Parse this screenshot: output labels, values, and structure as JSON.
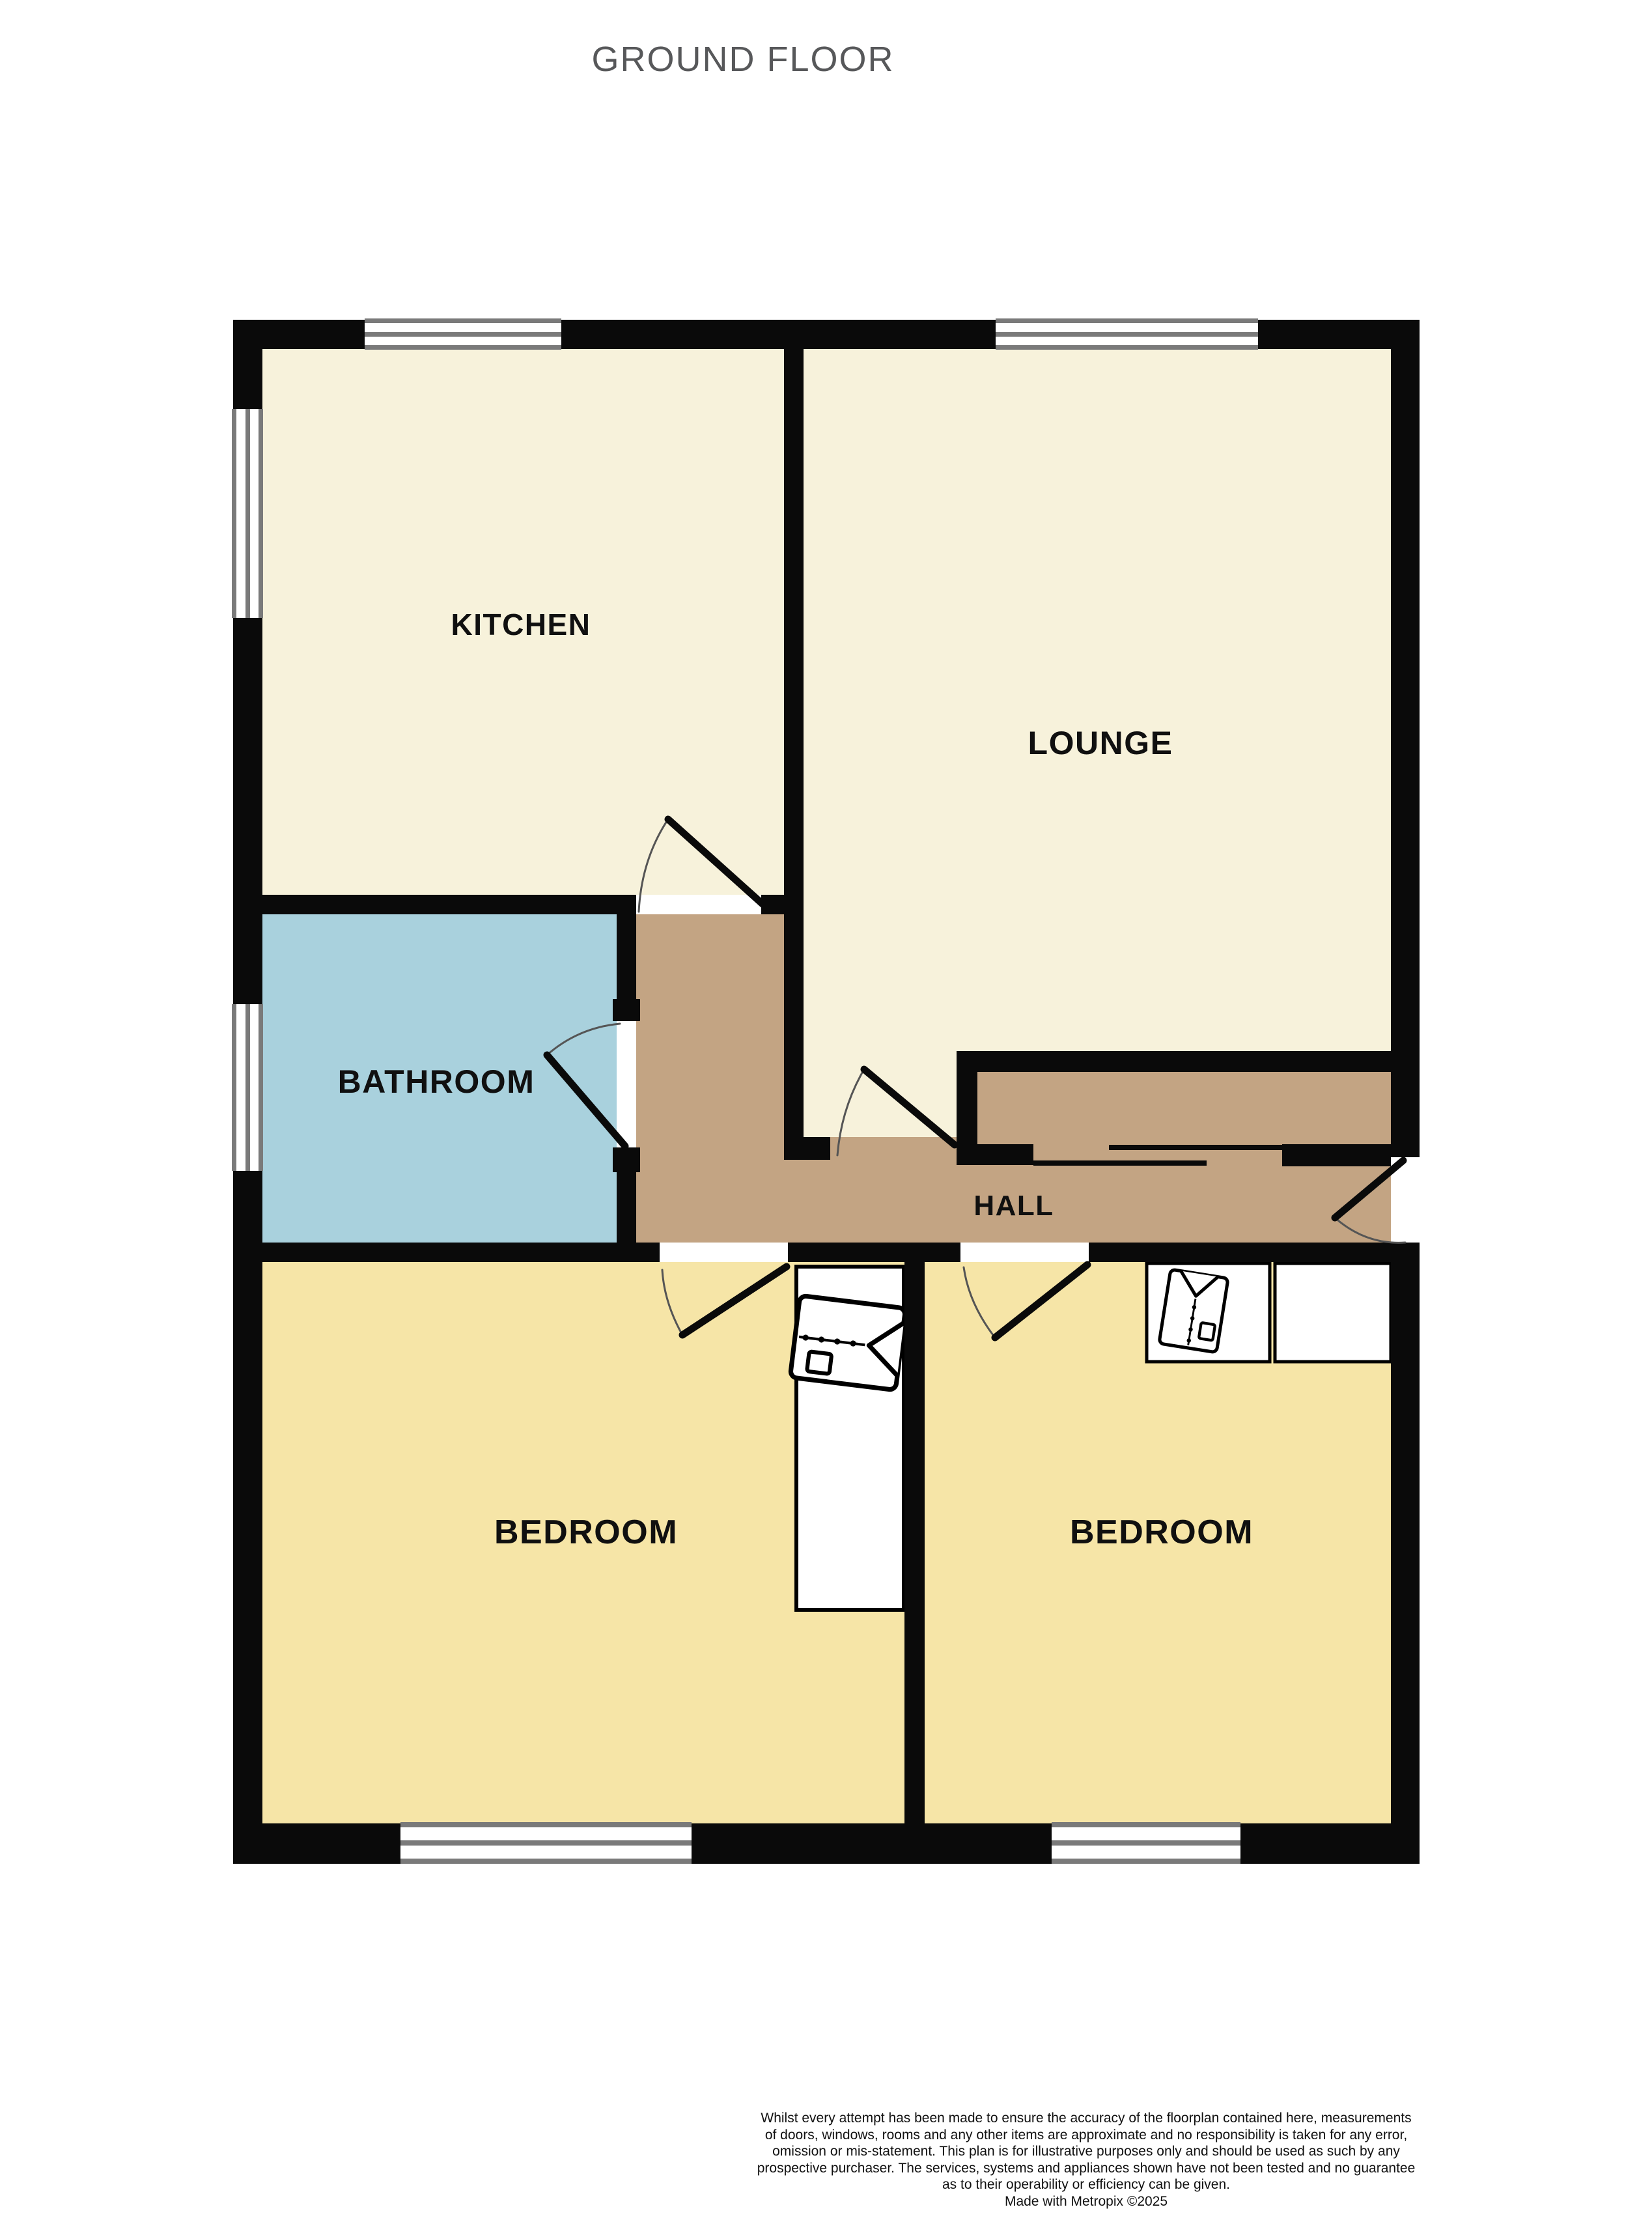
{
  "title": "GROUND FLOOR",
  "rooms": {
    "kitchen": {
      "label": "KITCHEN"
    },
    "lounge": {
      "label": "LOUNGE"
    },
    "bathroom": {
      "label": "BATHROOM"
    },
    "hall": {
      "label": "HALL"
    },
    "bedroom_left": {
      "label": "BEDROOM"
    },
    "bedroom_right": {
      "label": "BEDROOM"
    }
  },
  "colors": {
    "kitchen": "#F7F2DB",
    "lounge": "#F7F2DB",
    "bathroom": "#A9D1DD",
    "hall": "#C3A483",
    "bedroom": "#F6E5A7",
    "wall": "#0A0A0A",
    "window_frame": "#7A7A7A",
    "furniture_fill": "#FFFFFF",
    "title_text": "#57585A",
    "label_text": "#101010"
  },
  "disclaimer": {
    "lines": [
      "Whilst every attempt has been made to ensure the accuracy of the floorplan contained here, measurements",
      "of doors, windows, rooms and any other items are approximate and no responsibility is taken for any error,",
      "omission or mis-statement. This plan is for illustrative purposes only and should be used as such by any",
      "prospective purchaser. The services, systems and appliances shown have not been tested and no guarantee",
      "as to their operability or efficiency can be given.",
      "Made with Metropix ©2025"
    ]
  }
}
